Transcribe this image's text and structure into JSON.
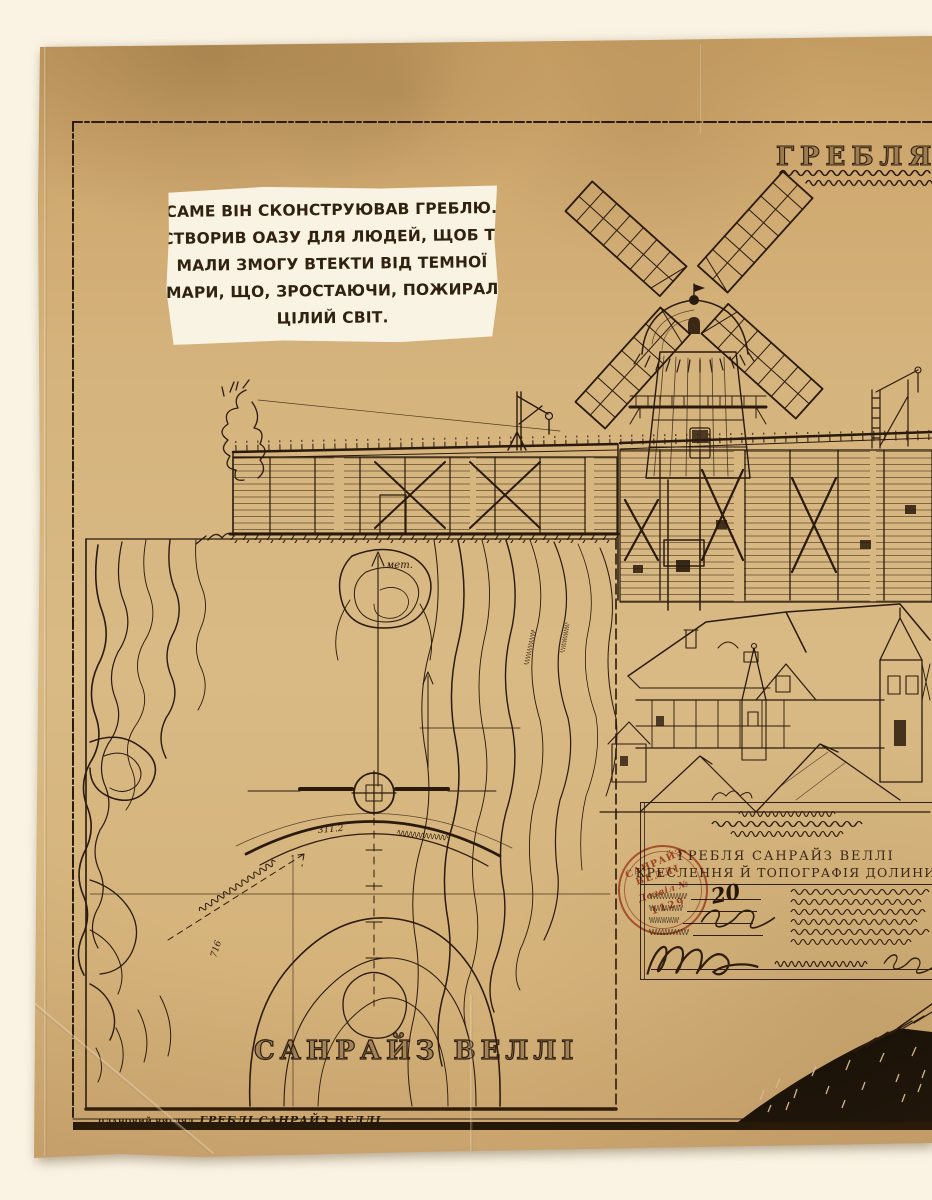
{
  "narration": {
    "lines": [
      "САМЕ ВІН СКОНСТРУЮВАВ ГРЕБЛЮ.",
      "СТВОРИВ ОАЗУ ДЛЯ ЛЮДЕЙ, ЩОБ ТІ",
      "МАЛИ ЗМОГУ ВТЕКТИ ВІД ТЕМНОЇ",
      "ХМАРИ, ЩО, ЗРОСТАЮЧИ, ПОЖИРАЛА",
      "ЦІЛИЙ СВІТ."
    ]
  },
  "sheet": {
    "main_title": "ГРЕБЛЯ СА",
    "map": {
      "title": "САНРАЙЗ ВЕЛЛІ",
      "annotations": {
        "meters_label": "мет.",
        "elevation_a": "311.2",
        "elevation_b": "716"
      }
    },
    "footer": {
      "small": "ПЛАНОВИЙ ВИГЛЯД",
      "label": "ГРЕБЛІ САНРАЙЗ ВЕЛЛІ"
    },
    "title_block": {
      "project": "ГРЕБЛЯ САНРАЙЗ ВЕЛЛІ",
      "subtitle": "КРЕСЛЕННЯ Й ТОПОГРАФІЯ ДОЛИНИ",
      "handwritten_number": "20"
    },
    "stamp": {
      "arc_top": "САНРАЙЗ",
      "arc_bottom": "ВЕЛЛІ",
      "permit_label": "Дозвіл №",
      "permit_number": "1129"
    }
  },
  "colors": {
    "background": "#faf3e3",
    "paper": "#d4b27c",
    "ink": "#2a1a0c",
    "stamp_red": "#b4482a",
    "narration_bg": "#f8f3e3"
  }
}
